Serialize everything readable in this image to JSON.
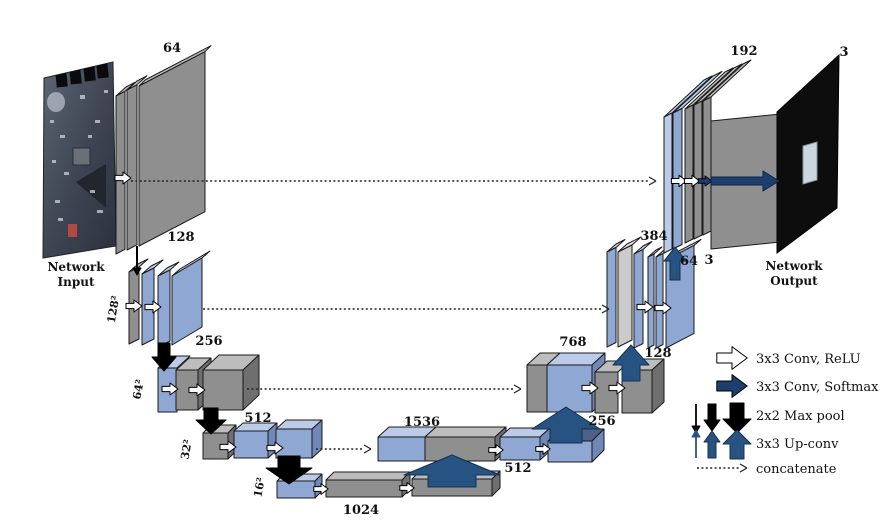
{
  "diagram": {
    "title_note": "U-Net style encoder-decoder network diagram",
    "input_caption_1": "Network",
    "input_caption_2": "Input",
    "output_caption_1": "Network",
    "output_caption_2": "Output",
    "encoder": {
      "l1_channels": "64",
      "l2_channels": "128",
      "l3_channels": "256",
      "l4_channels": "512",
      "bottleneck_channels": "1024",
      "size_l2": "128²",
      "size_l3": "64²",
      "size_l4": "32²",
      "size_l5": "16²"
    },
    "decoder": {
      "concat_32": "1536",
      "conv_32": "512",
      "upconv_to_64": "256",
      "concat_64": "768",
      "upconv_to_128": "128",
      "concat_128": "384",
      "conv_128_a": "64",
      "conv_128_b": "3",
      "concat_256": "192",
      "output_channels": "3"
    },
    "legend": {
      "conv_relu": "3x3 Conv, ReLU",
      "conv_softmax": "3x3 Conv, Softmax",
      "maxpool": "2x2 Max pool",
      "upconv": "3x3 Up-conv",
      "concatenate": "concatenate"
    },
    "colors": {
      "panel_blue": "#8fa7d3",
      "panel_blue_top": "#bccbe8",
      "panel_blue_side": "#7087b8",
      "panel_gray": "#8f8f8f",
      "panel_gray_top": "#bdbdbd",
      "panel_light_gray": "#cbcbcb",
      "arrow_softmax_navy": "#1d3f70",
      "arrow_upconv_blue": "#265381",
      "arrow_maxpool_black": "#000000",
      "output_image_bg": "#0d0d0d"
    }
  }
}
